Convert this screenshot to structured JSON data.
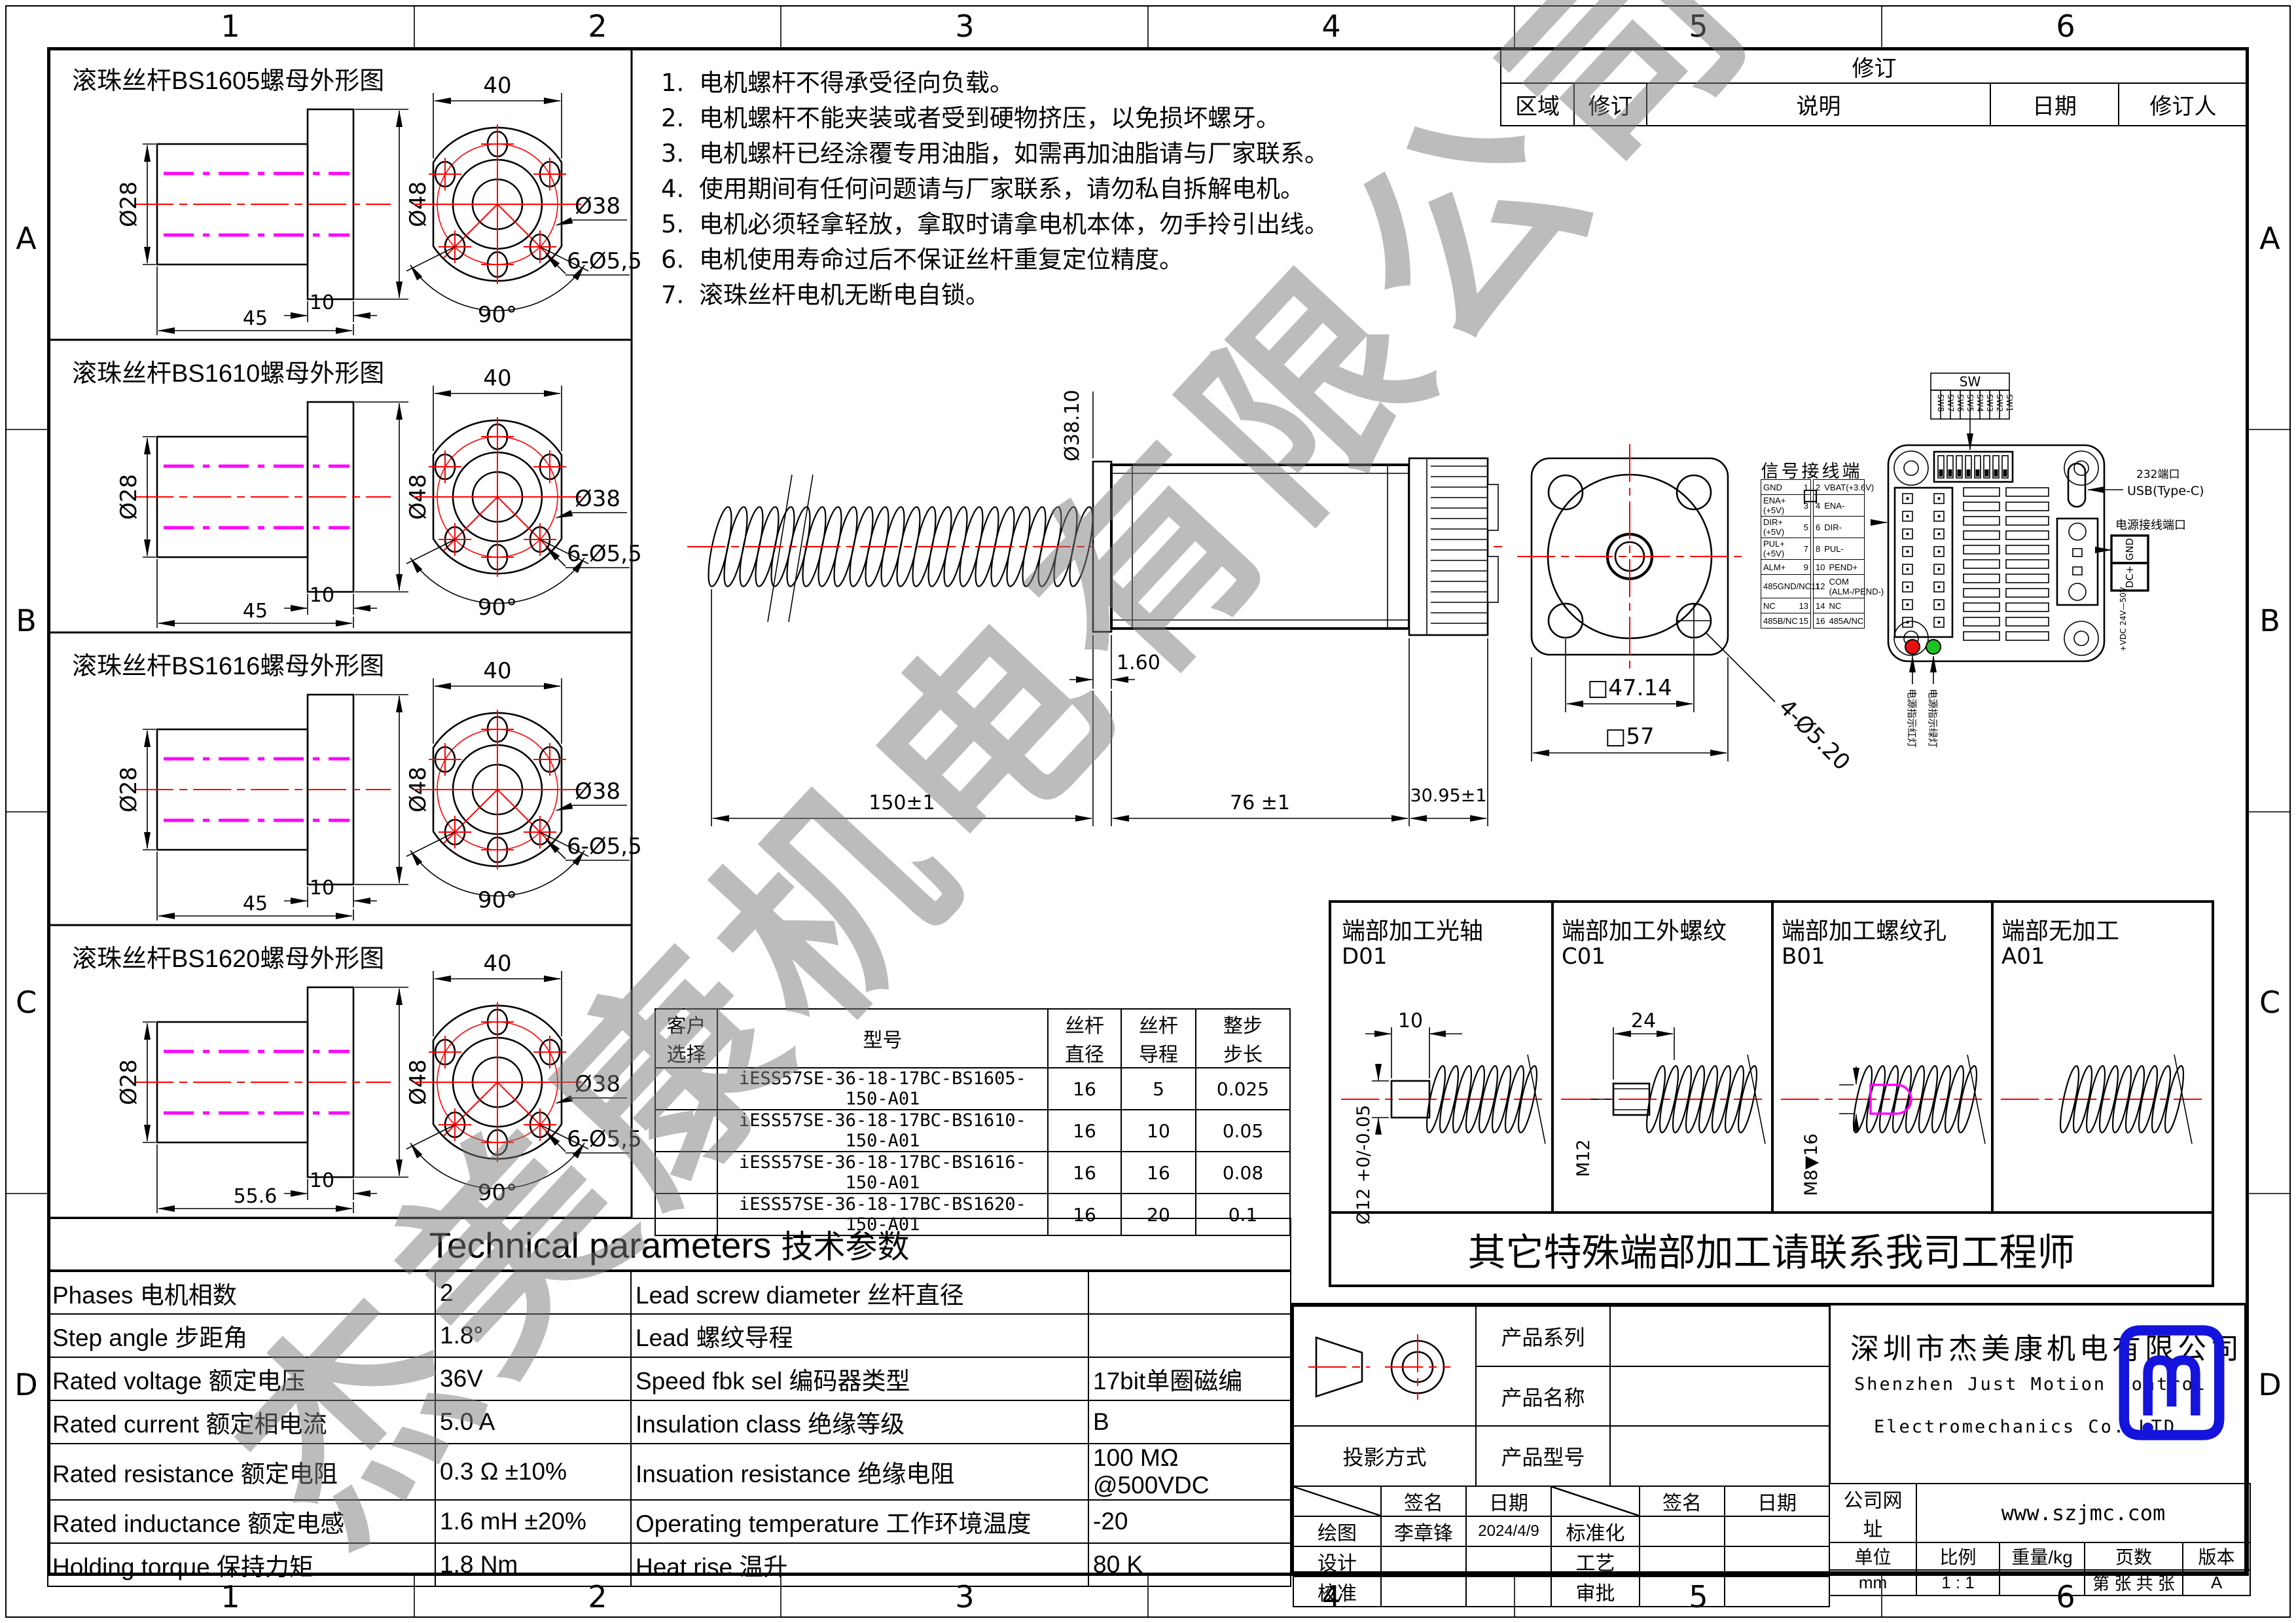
{
  "border": {
    "top_numbers": [
      "1",
      "2",
      "3",
      "4",
      "5",
      "6"
    ],
    "side_letters": [
      "A",
      "B",
      "C",
      "D"
    ]
  },
  "watermark": "杰美康机电有限公司",
  "colors": {
    "line": "#000000",
    "centerline_red": "#ff0000",
    "thread_magenta": "#ff00ff",
    "led_red": "#e8100c",
    "led_green": "#1ec421",
    "logo_blue": "#1414dd",
    "watermark_gray": "#7a7a7a"
  },
  "notes": {
    "items": [
      {
        "num": "1.",
        "text": "电机螺杆不得承受径向负载。"
      },
      {
        "num": "2.",
        "text": "电机螺杆不能夹装或者受到硬物挤压，以免损坏螺牙。"
      },
      {
        "num": "3.",
        "text": "电机螺杆已经涂覆专用油脂，如需再加油脂请与厂家联系。"
      },
      {
        "num": "4.",
        "text": "使用期间有任何问题请与厂家联系，请勿私自拆解电机。"
      },
      {
        "num": "5.",
        "text": "电机必须轻拿轻放，拿取时请拿电机本体，勿手拎引出线。"
      },
      {
        "num": "6.",
        "text": "电机使用寿命过后不保证丝杆重复定位精度。"
      },
      {
        "num": "7.",
        "text": "滚珠丝杆电机无断电自锁。"
      }
    ]
  },
  "revision_table": {
    "title": "修订",
    "headers": [
      "区域",
      "修订",
      "说明",
      "日期",
      "修订人"
    ]
  },
  "nut_panels": [
    {
      "title": "滚珠丝杆BS1605螺母外形图",
      "dia_inner": "Ø28",
      "dia_outer": "Ø48",
      "flange_w": "10",
      "length": "45",
      "width_dim": "40",
      "bolt_circle": "Ø38",
      "holes": "6-Ø5,5",
      "angle": "90°"
    },
    {
      "title": "滚珠丝杆BS1610螺母外形图",
      "dia_inner": "Ø28",
      "dia_outer": "Ø48",
      "flange_w": "10",
      "length": "45",
      "width_dim": "40",
      "bolt_circle": "Ø38",
      "holes": "6-Ø5,5",
      "angle": "90°"
    },
    {
      "title": "滚珠丝杆BS1616螺母外形图",
      "dia_inner": "Ø28",
      "dia_outer": "Ø48",
      "flange_w": "10",
      "length": "45",
      "width_dim": "40",
      "bolt_circle": "Ø38",
      "holes": "6-Ø5,5",
      "angle": "90°"
    },
    {
      "title": "滚珠丝杆BS1620螺母外形图",
      "dia_inner": "Ø28",
      "dia_outer": "Ø48",
      "flange_w": "10",
      "length": "55.6",
      "width_dim": "40",
      "bolt_circle": "Ø38",
      "holes": "6-Ø5,5",
      "angle": "90°"
    }
  ],
  "motor_view": {
    "dims": {
      "screw_dia": "Ø38.10",
      "washer": "1.60",
      "screw_len": "150±1",
      "body_len": "76 ±1",
      "driver_len": "30.95±1"
    }
  },
  "flange_view": {
    "dims": {
      "bolt_span": "□47.14",
      "body": "□57",
      "holes": "4-Ø5.20"
    }
  },
  "signal_port": {
    "title": "信号接线端口",
    "rows": [
      {
        "name_l": "GND",
        "pin_l": "1",
        "pin_r": "2",
        "name_r": "VBAT(+3.6V)"
      },
      {
        "name_l": "ENA+(+5V)",
        "pin_l": "3",
        "pin_r": "4",
        "name_r": "ENA-"
      },
      {
        "name_l": "DIR+(+5V)",
        "pin_l": "5",
        "pin_r": "6",
        "name_r": "DIR-"
      },
      {
        "name_l": "PUL+(+5V)",
        "pin_l": "7",
        "pin_r": "8",
        "name_r": "PUL-"
      },
      {
        "name_l": "ALM+",
        "pin_l": "9",
        "pin_r": "10",
        "name_r": "PEND+"
      },
      {
        "name_l": "485GND/NC",
        "pin_l": "11",
        "pin_r": "12",
        "name_r": "COM\n(ALM-/PEND-)"
      },
      {
        "name_l": "NC",
        "pin_l": "13",
        "pin_r": "14",
        "name_r": "NC"
      },
      {
        "name_l": "485B/NC",
        "pin_l": "15",
        "pin_r": "16",
        "name_r": "485A/NC"
      }
    ]
  },
  "driver_view": {
    "sw_title": "SW",
    "sw_labels": [
      "SW8",
      "SW7",
      "SW6",
      "SW5",
      "SW4",
      "SW3",
      "SW2",
      "SW1"
    ],
    "usb_label_1": "232端口",
    "usb_label_2": "USB(Type-C)",
    "power_title": "电源接线端口",
    "power_pins": [
      "GND",
      "DC+"
    ],
    "power_range": "+VDC 24V—50V",
    "led_red_label": "电源指示红灯",
    "led_green_label": "电源指示绿灯"
  },
  "machining": {
    "panels": [
      {
        "title": "端部加工光轴",
        "code": "D01",
        "dim_top": "10",
        "dim_side": "Ø12 +0/-0.05"
      },
      {
        "title": "端部加工外螺纹",
        "code": "C01",
        "dim_top": "24",
        "dim_side": "M12"
      },
      {
        "title": "端部加工螺纹孔",
        "code": "B01",
        "dim_top": "",
        "dim_side": "M8▼16"
      },
      {
        "title": "端部无加工",
        "code": "A01",
        "dim_top": "",
        "dim_side": ""
      }
    ],
    "banner": "其它特殊端部加工请联系我司工程师"
  },
  "part_table": {
    "headers": [
      "客户\n选择",
      "型号",
      "丝杆\n直径",
      "丝杆\n导程",
      "整步\n步长"
    ],
    "rows": [
      {
        "choice": "",
        "model": "iESS57SE-36-18-17BC-BS1605-150-A01",
        "dia": "16",
        "lead": "5",
        "step": "0.025"
      },
      {
        "choice": "",
        "model": "iESS57SE-36-18-17BC-BS1610-150-A01",
        "dia": "16",
        "lead": "10",
        "step": "0.05"
      },
      {
        "choice": "",
        "model": "iESS57SE-36-18-17BC-BS1616-150-A01",
        "dia": "16",
        "lead": "16",
        "step": "0.08"
      },
      {
        "choice": "",
        "model": "iESS57SE-36-18-17BC-BS1620-150-A01",
        "dia": "16",
        "lead": "20",
        "step": "0.1"
      }
    ]
  },
  "tech_table": {
    "title_en": "Technical parameters",
    "title_cn": "技术参数",
    "rows": [
      {
        "l1": "Phases 电机相数",
        "v1": "2",
        "l2": "Lead screw diameter 丝杆直径",
        "v2": ""
      },
      {
        "l1": "Step angle 步距角",
        "v1": "1.8°",
        "l2": "Lead 螺纹导程",
        "v2": ""
      },
      {
        "l1": "Rated voltage 额定电压",
        "v1": "36V",
        "l2": "Speed fbk sel  编码器类型",
        "v2": "17bit单圈磁编"
      },
      {
        "l1": "Rated current 额定相电流",
        "v1": "5.0 A",
        "l2": "Insulation class 绝缘等级",
        "v2": "B"
      },
      {
        "l1": "Rated resistance 额定电阻",
        "v1": "0.3 Ω  ±10%",
        "l2": "Insuation resistance 绝缘电阻",
        "v2": "100 MΩ @500VDC"
      },
      {
        "l1": "Rated inductance 额定电感",
        "v1": "1.6 mH ±20%",
        "l2": "Operating temperature 工作环境温度",
        "v2": "-20"
      },
      {
        "l1": "Holding torque 保持力矩",
        "v1": "1.8 Nm",
        "l2": "Heat rise 温升",
        "v2": "80 K"
      }
    ]
  },
  "title_block": {
    "product_series": "产品系列",
    "product_name": "产品名称",
    "product_model": "产品型号",
    "projection": "投影方式",
    "sign_header_1": "签名",
    "sign_header_2": "日期",
    "rows": [
      {
        "left": "绘图",
        "name": "李章锋",
        "date": "2024/4/9",
        "right": "标准化"
      },
      {
        "left": "设计",
        "name": "",
        "date": "",
        "right": "工艺"
      },
      {
        "left": "校准",
        "name": "",
        "date": "",
        "right": "审批"
      }
    ],
    "company_cn": "深圳市杰美康机电有限公司",
    "company_en1": "Shenzhen Just Motion Control",
    "company_en2": "Electromechanics Co.,LTD",
    "site_label": "公司网址",
    "site": "www.szjmc.com",
    "meta_headers": [
      "单位",
      "比例",
      "重量/kg",
      "页数",
      "版本"
    ],
    "meta_values": [
      "mm",
      "1 : 1",
      "",
      "第 张 共 张",
      "A"
    ]
  }
}
